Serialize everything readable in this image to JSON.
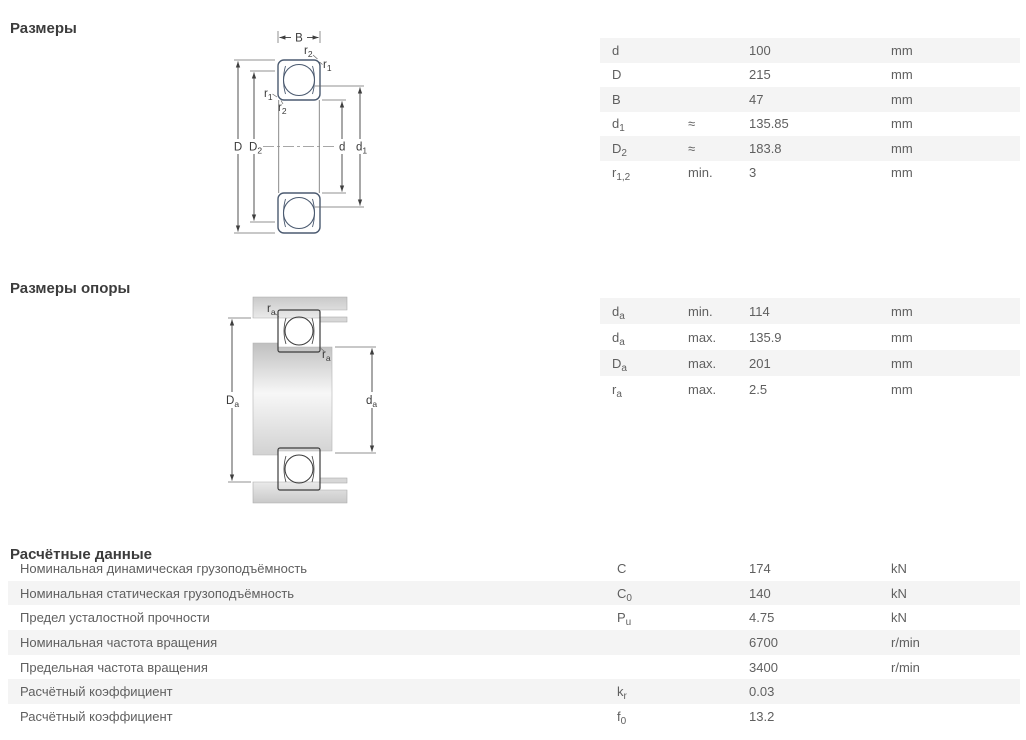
{
  "colors": {
    "bearing_section_fill": "#c8d5ec",
    "bearing_outline": "#4b5a70",
    "row_shade": "#f4f4f4",
    "text": "#5f5f5f"
  },
  "dimensions": {
    "heading": "Размеры",
    "rows": [
      {
        "sym": "d",
        "sub": "",
        "qual": "",
        "value": "100",
        "unit": "mm"
      },
      {
        "sym": "D",
        "sub": "",
        "qual": "",
        "value": "215",
        "unit": "mm"
      },
      {
        "sym": "B",
        "sub": "",
        "qual": "",
        "value": "47",
        "unit": "mm"
      },
      {
        "sym": "d",
        "sub": "1",
        "qual": "≈",
        "value": "135.85",
        "unit": "mm"
      },
      {
        "sym": "D",
        "sub": "2",
        "qual": "≈",
        "value": "183.8",
        "unit": "mm"
      },
      {
        "sym": "r",
        "sub": "1,2",
        "qual": "min.",
        "value": "3",
        "unit": "mm"
      }
    ]
  },
  "abutment": {
    "heading": "Размеры опоры",
    "rows": [
      {
        "sym": "d",
        "sub": "a",
        "qual": "min.",
        "value": "114",
        "unit": "mm"
      },
      {
        "sym": "d",
        "sub": "a",
        "qual": "max.",
        "value": "135.9",
        "unit": "mm"
      },
      {
        "sym": "D",
        "sub": "a",
        "qual": "max.",
        "value": "201",
        "unit": "mm"
      },
      {
        "sym": "r",
        "sub": "a",
        "qual": "max.",
        "value": "2.5",
        "unit": "mm"
      }
    ]
  },
  "calculation": {
    "heading": "Расчётные данные",
    "rows": [
      {
        "label": "Номинальная динамическая грузоподъёмность",
        "sym": "C",
        "sub": "",
        "value": "174",
        "unit": "kN"
      },
      {
        "label": "Номинальная статическая грузоподъёмность",
        "sym": "C",
        "sub": "0",
        "value": "140",
        "unit": "kN"
      },
      {
        "label": "Предел усталостной прочности",
        "sym": "P",
        "sub": "u",
        "value": "4.75",
        "unit": "kN"
      },
      {
        "label": "Номинальная частота вращения",
        "sym": "",
        "sub": "",
        "value": "6700",
        "unit": "r/min"
      },
      {
        "label": "Предельная частота вращения",
        "sym": "",
        "sub": "",
        "value": "3400",
        "unit": "r/min"
      },
      {
        "label": "Расчётный коэффициент",
        "sym": "k",
        "sub": "r",
        "value": "0.03",
        "unit": ""
      },
      {
        "label": "Расчётный коэффициент",
        "sym": "f",
        "sub": "0",
        "value": "13.2",
        "unit": ""
      }
    ]
  },
  "diagram1": {
    "labels": {
      "B": "B",
      "D": "D",
      "D2_base": "D",
      "D2_sub": "2",
      "d": "d",
      "d1_base": "d",
      "d1_sub": "1",
      "r1_base": "r",
      "r1_sub": "1",
      "r2_base": "r",
      "r2_sub": "2"
    }
  },
  "diagram2": {
    "labels": {
      "Da_base": "D",
      "Da_sub": "a",
      "da_base": "d",
      "da_sub": "a",
      "ra_base": "r",
      "ra_sub": "a"
    }
  }
}
